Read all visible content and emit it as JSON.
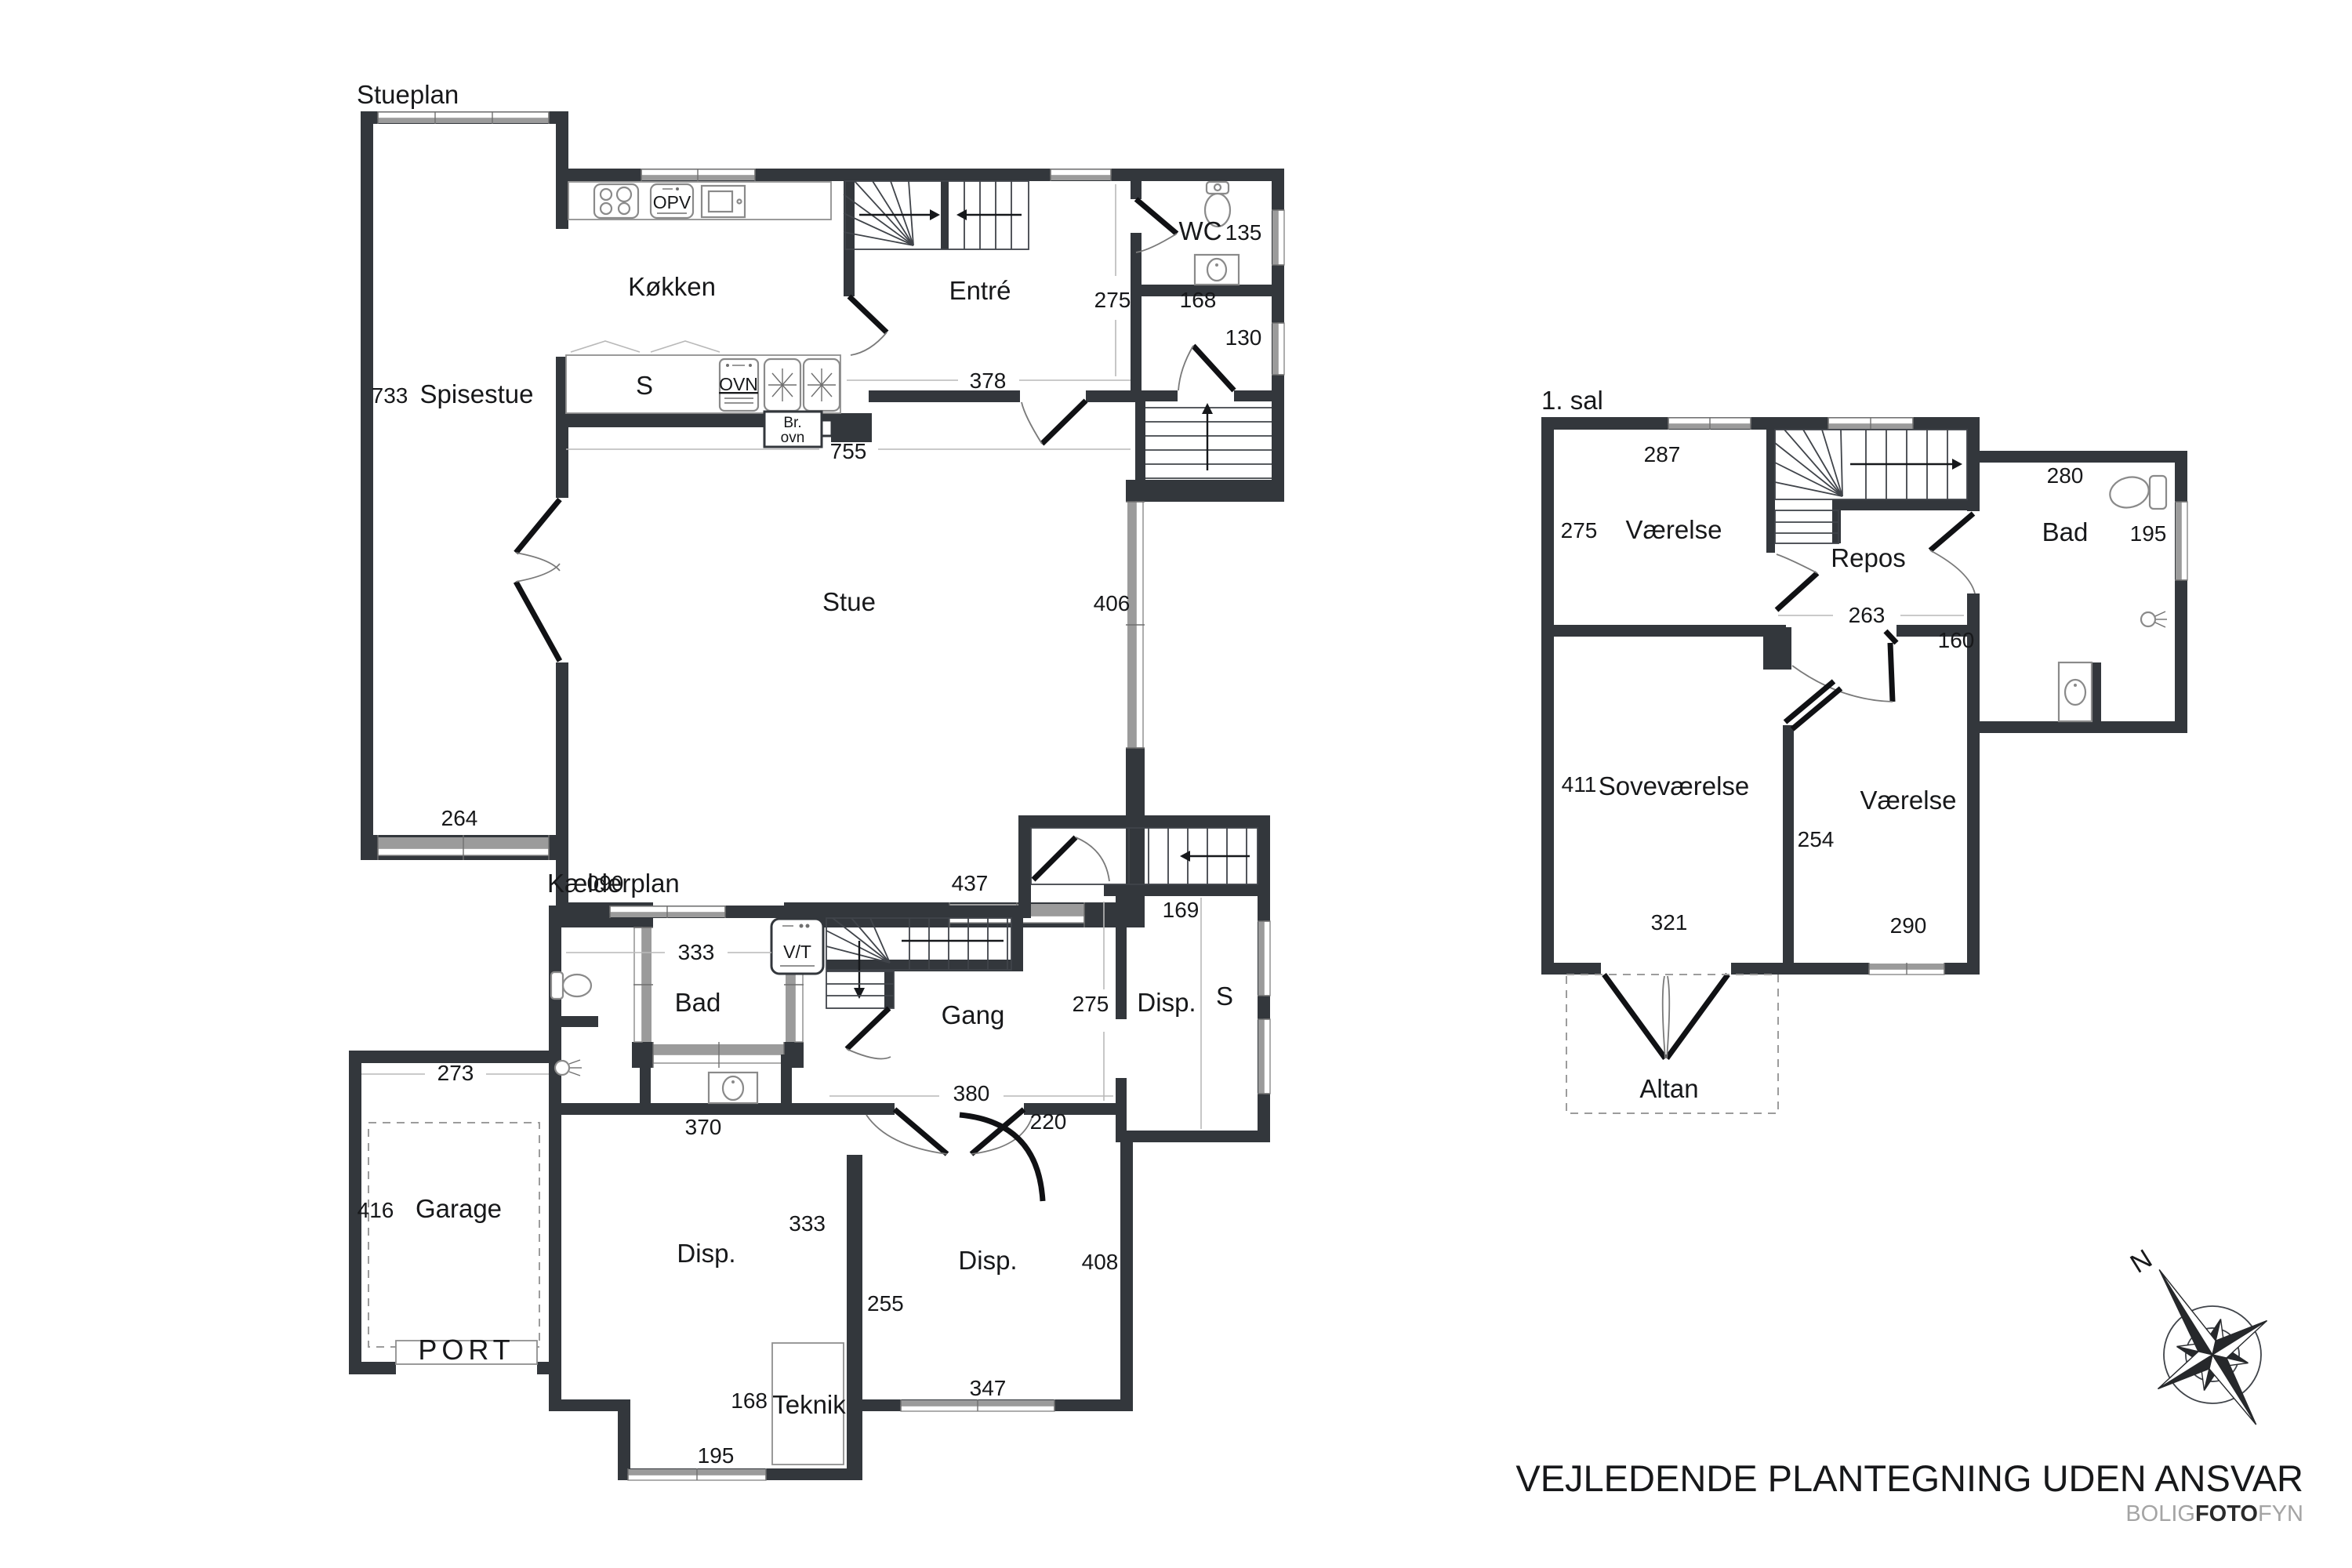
{
  "meta": {
    "drawing_type": "floor-plan"
  },
  "colors": {
    "wall": "#33373c",
    "window_band": "#9b9b9b",
    "text": "#17181a",
    "brand_gray": "#a4a4a4"
  },
  "stueplan": {
    "title": "Stueplan",
    "rooms": {
      "spisestue": "Spisestue",
      "koekken": "Køkken",
      "entre": "Entré",
      "wc": "WC",
      "stue": "Stue"
    },
    "fixtures": {
      "opv": "OPV",
      "ovn": "OVN",
      "s": "S",
      "br_line1": "Br.",
      "br_line2": "ovn"
    },
    "dims": {
      "w733": "733",
      "w264": "264",
      "w755": "755",
      "w378": "378",
      "w275": "275",
      "w135": "135",
      "w168": "168",
      "w130": "130",
      "w406": "406",
      "w090": "090",
      "w437": "437"
    }
  },
  "first_floor": {
    "title": "1. sal",
    "rooms": {
      "vaerelse_nw": "Værelse",
      "repos": "Repos",
      "bad": "Bad",
      "sovevaerelse": "Soveværelse",
      "vaerelse_se": "Værelse",
      "altan": "Altan"
    },
    "dims": {
      "w287": "287",
      "w275": "275",
      "w280": "280",
      "w195": "195",
      "w263": "263",
      "w160": "160",
      "w411": "411",
      "w254": "254",
      "w321": "321",
      "w290": "290"
    }
  },
  "basement": {
    "title": "Kælderplan",
    "rooms": {
      "bad": "Bad",
      "gang": "Gang",
      "disp_ne": "Disp.",
      "disp_sw": "Disp.",
      "disp_se": "Disp.",
      "garage": "Garage",
      "teknik": "Teknik"
    },
    "labels": {
      "port": "PORT"
    },
    "fixtures": {
      "vt": "V/T",
      "s": "S"
    },
    "dims": {
      "w333a": "333",
      "w275": "275",
      "w169": "169",
      "w273": "273",
      "w416": "416",
      "w370": "370",
      "w380": "380",
      "w220": "220",
      "w333b": "333",
      "w255": "255",
      "w408": "408",
      "w347": "347",
      "w168": "168",
      "w195": "195"
    }
  },
  "compass": {
    "north": "N"
  },
  "footer": {
    "disclaimer": "VEJLEDENDE PLANTEGNING UDEN ANSVAR",
    "brand": {
      "part1": "BOLIG",
      "part2": "FOTO",
      "part3": "FYN"
    }
  }
}
